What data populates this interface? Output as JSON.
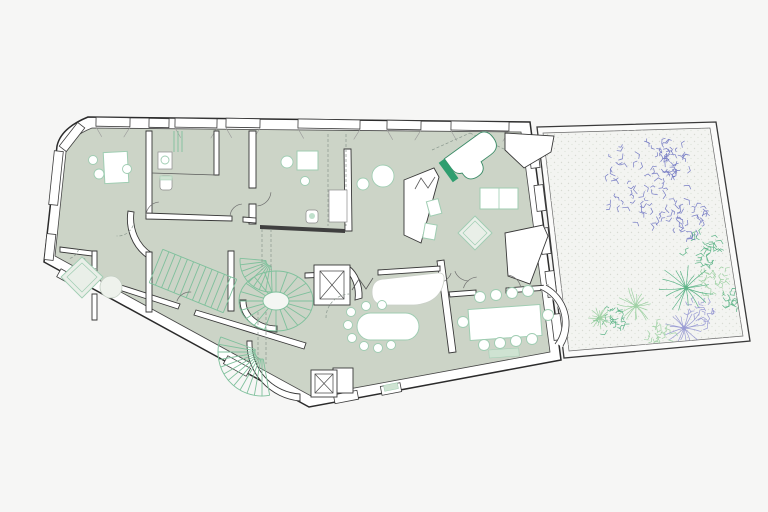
{
  "meta": {
    "label": "Architectural floor plan of an irregular apartment level with walled garden",
    "building_label": "apartment-floor",
    "garden_label": "walled-garden"
  },
  "colors": {
    "background": "#f6f6f5",
    "floor": "#ccd4c7",
    "wall_line": "#383838",
    "stair_green": "#7fc09c",
    "furniture_green": "#9fcdb2",
    "accent_green": "#2e9e6f",
    "garden_fill": "#f3f4f1",
    "garden_dot": "#d8dbd3",
    "plant_blue": "#6a70c0",
    "plant_green": "#4fae7e",
    "plant_green_light": "#98cf9e",
    "plant_purple": "#9193d1",
    "dash_gray": "#8a988e"
  },
  "plan": {
    "windows": [
      {
        "x": 113,
        "y": 122,
        "len": 34,
        "a": 1,
        "splay": true
      },
      {
        "x": 159,
        "y": 123,
        "len": 20,
        "a": 1,
        "splay": false
      },
      {
        "x": 196,
        "y": 123,
        "len": 42,
        "a": 1,
        "splay": true
      },
      {
        "x": 243,
        "y": 123,
        "len": 34,
        "a": 1,
        "splay": true
      },
      {
        "x": 329,
        "y": 124,
        "len": 62,
        "a": 1,
        "splay": true
      },
      {
        "x": 404,
        "y": 125,
        "len": 34,
        "a": 1,
        "splay": true
      },
      {
        "x": 480,
        "y": 126,
        "len": 58,
        "a": 1,
        "splay": true
      },
      {
        "x": 72,
        "y": 137,
        "len": 30,
        "a": -52,
        "splay": false
      },
      {
        "x": 56,
        "y": 178,
        "len": 54,
        "a": 96,
        "splay": false
      },
      {
        "x": 50,
        "y": 247,
        "len": 26,
        "a": 96,
        "splay": false
      },
      {
        "x": 72,
        "y": 280,
        "len": 30,
        "a": 29,
        "splay": false
      },
      {
        "x": 237,
        "y": 366,
        "len": 26,
        "a": 29,
        "splay": false
      },
      {
        "x": 346,
        "y": 397,
        "len": 24,
        "a": -11,
        "splay": false
      },
      {
        "x": 391,
        "y": 389,
        "len": 20,
        "a": -11,
        "splay": false
      },
      {
        "x": 534,
        "y": 155,
        "len": 26,
        "a": 83,
        "splay": false
      },
      {
        "x": 540,
        "y": 198,
        "len": 26,
        "a": 83,
        "splay": false
      },
      {
        "x": 545,
        "y": 241,
        "len": 26,
        "a": 83,
        "splay": false
      },
      {
        "x": 551,
        "y": 284,
        "len": 26,
        "a": 83,
        "splay": false
      },
      {
        "x": 557,
        "y": 327,
        "len": 26,
        "a": 83,
        "splay": false
      }
    ],
    "stairs": [
      {
        "t": "fan",
        "cx": 276,
        "cy": 301,
        "rx1": 13,
        "ry1": 9,
        "rx2": 37,
        "ry2": 30,
        "a0": 0,
        "a1": 360,
        "n": 20
      },
      {
        "t": "fan",
        "cx": 262,
        "cy": 352,
        "r1": 7,
        "r2": 44,
        "a0": 80,
        "a1": 200,
        "n": 12
      },
      {
        "t": "fan",
        "cx": 271,
        "cy": 261,
        "r1": 5,
        "r2": 31,
        "a0": 88,
        "a1": 185,
        "n": 8
      },
      {
        "t": "str",
        "x1": 156,
        "y1": 266,
        "x2": 230,
        "y2": 296,
        "w": 36,
        "n": 12
      },
      {
        "t": "lines",
        "v": [
          [
            174,
            131,
            174,
            152
          ],
          [
            178,
            131,
            178,
            152
          ],
          [
            182,
            131,
            182,
            152
          ]
        ]
      }
    ],
    "arcs": [
      {
        "cx": 160,
        "cy": 216,
        "r": 14,
        "a0": 185,
        "a1": 265,
        "dash": false
      },
      {
        "cx": 243,
        "cy": 217,
        "r": 13,
        "a0": 185,
        "a1": 265,
        "dash": false
      },
      {
        "cx": 256,
        "cy": 191,
        "r": 15,
        "a0": 5,
        "a1": 85,
        "dash": false
      },
      {
        "cx": 99,
        "cy": 254,
        "r": 15,
        "a0": 95,
        "a1": 170,
        "dash": true
      },
      {
        "cx": 66,
        "cy": 246,
        "r": 13,
        "a0": 15,
        "a1": 80,
        "dash": true
      },
      {
        "cx": 190,
        "cy": 306,
        "r": 14,
        "a0": 200,
        "a1": 275,
        "dash": false
      },
      {
        "cx": 437,
        "cy": 268,
        "r": 15,
        "a0": 20,
        "a1": 88,
        "dash": false
      },
      {
        "cx": 469,
        "cy": 266,
        "r": 15,
        "a0": 92,
        "a1": 160,
        "dash": false
      },
      {
        "cx": 478,
        "cy": 292,
        "r": 15,
        "a0": 195,
        "a1": 265,
        "dash": false
      },
      {
        "cx": 506,
        "cy": 290,
        "r": 15,
        "a0": 275,
        "a1": 345,
        "dash": false
      },
      {
        "cx": 350,
        "cy": 318,
        "r": 24,
        "a0": 180,
        "a1": 268,
        "dash": true
      },
      {
        "cx": 118,
        "cy": 220,
        "r": 16,
        "a0": 20,
        "a1": 95,
        "dash": true
      }
    ],
    "zigzags": [
      {
        "p": "415,189 421,178 428,188 435,177"
      },
      {
        "p": "352,290 359,279 366,289 373,278"
      }
    ],
    "dashes": [
      {
        "x1": 262,
        "y1": 229,
        "x2": 262,
        "y2": 270
      },
      {
        "x1": 271,
        "y1": 229,
        "x2": 271,
        "y2": 270
      },
      {
        "x1": 328,
        "y1": 134,
        "x2": 328,
        "y2": 226
      },
      {
        "x1": 346,
        "y1": 134,
        "x2": 346,
        "y2": 226
      },
      {
        "x1": 258,
        "y1": 312,
        "x2": 258,
        "y2": 364
      },
      {
        "x1": 266,
        "y1": 312,
        "x2": 266,
        "y2": 364
      },
      {
        "x1": 432,
        "y1": 150,
        "x2": 470,
        "y2": 133
      },
      {
        "x1": 470,
        "y1": 133,
        "x2": 506,
        "y2": 150
      }
    ],
    "plants": [
      {
        "t": "canopy",
        "x": 648,
        "y": 180,
        "r": 46,
        "c": "plant_blue",
        "seed": 3
      },
      {
        "t": "canopy",
        "x": 668,
        "y": 158,
        "r": 18,
        "c": "plant_blue",
        "seed": 43
      },
      {
        "t": "canopy",
        "x": 688,
        "y": 222,
        "r": 20,
        "c": "plant_blue",
        "seed": 7
      },
      {
        "t": "canopy",
        "x": 700,
        "y": 250,
        "r": 18,
        "c": "plant_green",
        "seed": 11
      },
      {
        "t": "canopy",
        "x": 714,
        "y": 283,
        "r": 16,
        "c": "plant_green_light",
        "seed": 13
      },
      {
        "t": "canopy",
        "x": 704,
        "y": 310,
        "r": 14,
        "c": "plant_purple",
        "seed": 17
      },
      {
        "t": "burst",
        "x": 686,
        "y": 288,
        "r": 27,
        "c": "plant_green",
        "seed": 19
      },
      {
        "t": "burst",
        "x": 684,
        "y": 328,
        "r": 20,
        "c": "plant_purple",
        "seed": 23
      },
      {
        "t": "burst",
        "x": 636,
        "y": 306,
        "r": 19,
        "c": "plant_green_light",
        "seed": 29
      },
      {
        "t": "canopy",
        "x": 612,
        "y": 320,
        "r": 15,
        "c": "plant_green",
        "seed": 31
      },
      {
        "t": "canopy",
        "x": 660,
        "y": 333,
        "r": 13,
        "c": "plant_green_light",
        "seed": 37
      },
      {
        "t": "canopy",
        "x": 734,
        "y": 302,
        "r": 11,
        "c": "plant_green",
        "seed": 41
      },
      {
        "t": "burst",
        "x": 600,
        "y": 318,
        "r": 13,
        "c": "plant_green_light",
        "seed": 47
      }
    ]
  }
}
